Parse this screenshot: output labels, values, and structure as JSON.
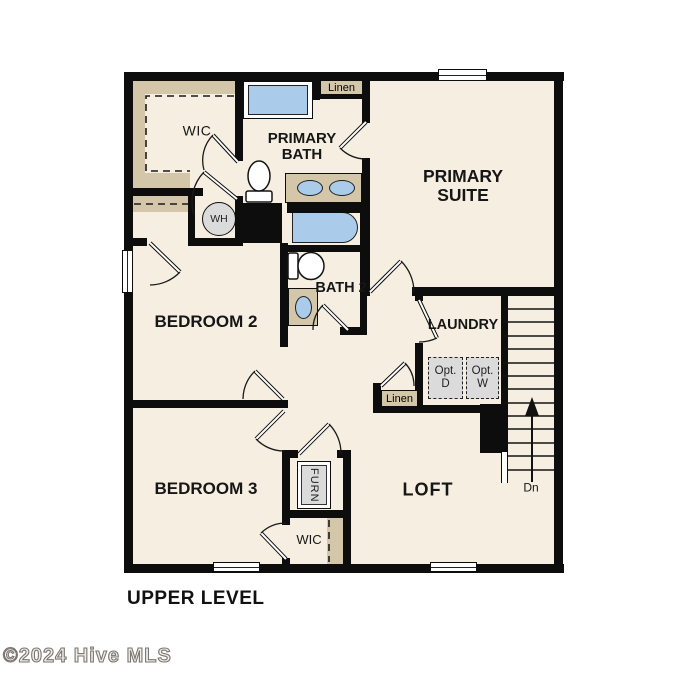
{
  "plan": {
    "level_title": "UPPER LEVEL",
    "copyright": "©2024 Hive MLS"
  },
  "rooms": {
    "wic_primary": "WIC",
    "primary_bath": "PRIMARY BATH",
    "primary_suite": "PRIMARY SUITE",
    "bedroom2": "BEDROOM 2",
    "bath2": "BATH 2",
    "laundry": "LAUNDRY",
    "bedroom3": "BEDROOM 3",
    "loft": "LOFT",
    "wic_bedroom3": "WIC"
  },
  "fixtures": {
    "linen_top": "Linen",
    "linen_hall": "Linen",
    "water_heater": "WH",
    "furnace": "FURN",
    "opt_dryer": "Opt. D",
    "opt_washer": "Opt. W",
    "stairs_down": "Dn"
  },
  "colors": {
    "wall": "#0d0d0d",
    "floor": "#f6efe1",
    "shelf": "#d3c6a9",
    "blue": "#aacbea",
    "gray": "#dbdbdb"
  }
}
